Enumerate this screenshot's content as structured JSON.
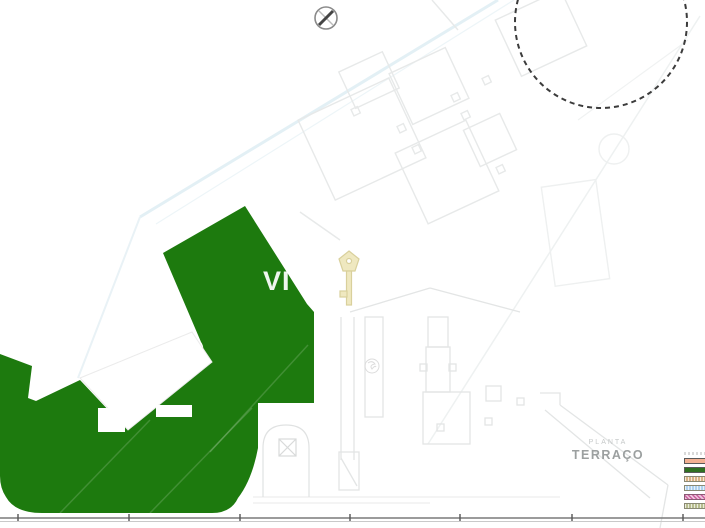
{
  "plan": {
    "label_small": "PLANTA",
    "label_large": "TERRAÇO"
  },
  "watermark": {
    "text": "VI"
  },
  "icons": {
    "north_marker": "circle-x-survey-marker",
    "key_watermark": "antique-key",
    "tree_marker": "tree-scribble"
  },
  "colors": {
    "terrace_green": "#1d7a0e",
    "line_light": "#e7e9e9",
    "line_faint": "#f0f2f2",
    "line_blue": "#e2f0f6",
    "dashed_circle": "#3c3c3c",
    "marker_gray": "#8a8a8a",
    "key_fill": "#efe8c0",
    "key_stroke": "#d9d09c",
    "titleblock_line": "#7a7a7a"
  },
  "legend": {
    "items": [
      {
        "name": "legend-title-strip",
        "color": "#d9d9d9",
        "style": "text"
      },
      {
        "name": "legend-salmon",
        "color": "#f3b092",
        "style": "solid"
      },
      {
        "name": "legend-dark-green",
        "color": "#2f7021",
        "style": "solid"
      },
      {
        "name": "legend-tan-dotted",
        "color": "#d9b285",
        "style": "dotted"
      },
      {
        "name": "legend-light-blue",
        "color": "#aed1ef",
        "style": "dotted"
      },
      {
        "name": "legend-magenta-checker",
        "color": "#cc5f9e",
        "style": "checker"
      },
      {
        "name": "legend-olive-dotted",
        "color": "#b7bd8e",
        "style": "dotted"
      }
    ]
  }
}
